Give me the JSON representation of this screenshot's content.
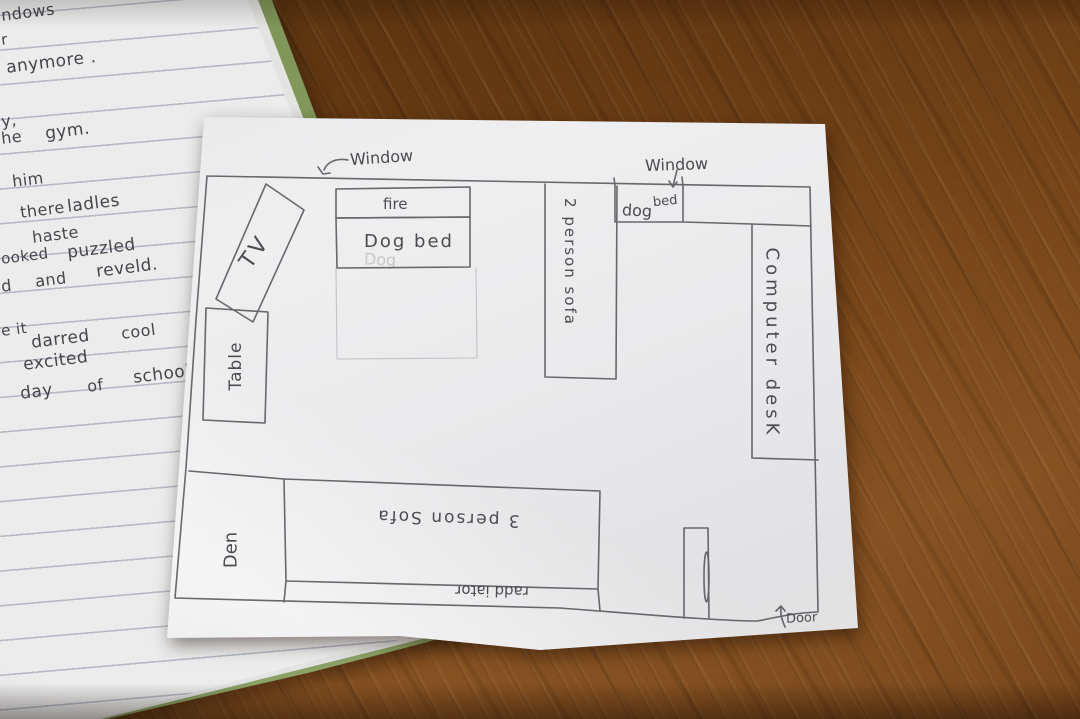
{
  "scene": {
    "description": "Photo of a hand-drawn den floor plan on paper, on a wooden table, partly covering a lined notebook with handwriting",
    "colors": {
      "wood": "#784619",
      "plan_paper": "#eaeaec",
      "notebook_paper": "#ececec",
      "notebook_cover_green": "#88a063",
      "rule_line": "#b5bbc6",
      "pencil": "#55555c"
    }
  },
  "notebook": {
    "lines": [
      {
        "t": "ndows"
      },
      {
        "t": "r"
      },
      {
        "t": "anymore ."
      },
      {
        "t": "y,"
      },
      {
        "t": "he"
      },
      {
        "t": "gym."
      },
      {
        "t": "him"
      },
      {
        "t": "there"
      },
      {
        "t": "ladles"
      },
      {
        "t": "haste"
      },
      {
        "t": "ooked"
      },
      {
        "t": "puzzled"
      },
      {
        "t": "d"
      },
      {
        "t": "and"
      },
      {
        "t": "reveld."
      },
      {
        "t": "e it"
      },
      {
        "t": "darred"
      },
      {
        "t": "cool"
      },
      {
        "t": "excited"
      },
      {
        "t": "day"
      },
      {
        "t": "of"
      },
      {
        "t": "school"
      }
    ]
  },
  "plan": {
    "room_name": "Den",
    "labels": {
      "window1": "Window",
      "window2": "Window",
      "fire": "fire",
      "dog_bed": "Dog bed",
      "dog": "dog",
      "bed": "bed",
      "sofa2": "2 person sofa",
      "computer_desk": "Computer desK",
      "table": "Table",
      "tv": "TV",
      "den": "Den",
      "sofa3": "3 person Sofa",
      "radiator": "radd iator",
      "door": "Door",
      "ghost": "Dog"
    }
  }
}
